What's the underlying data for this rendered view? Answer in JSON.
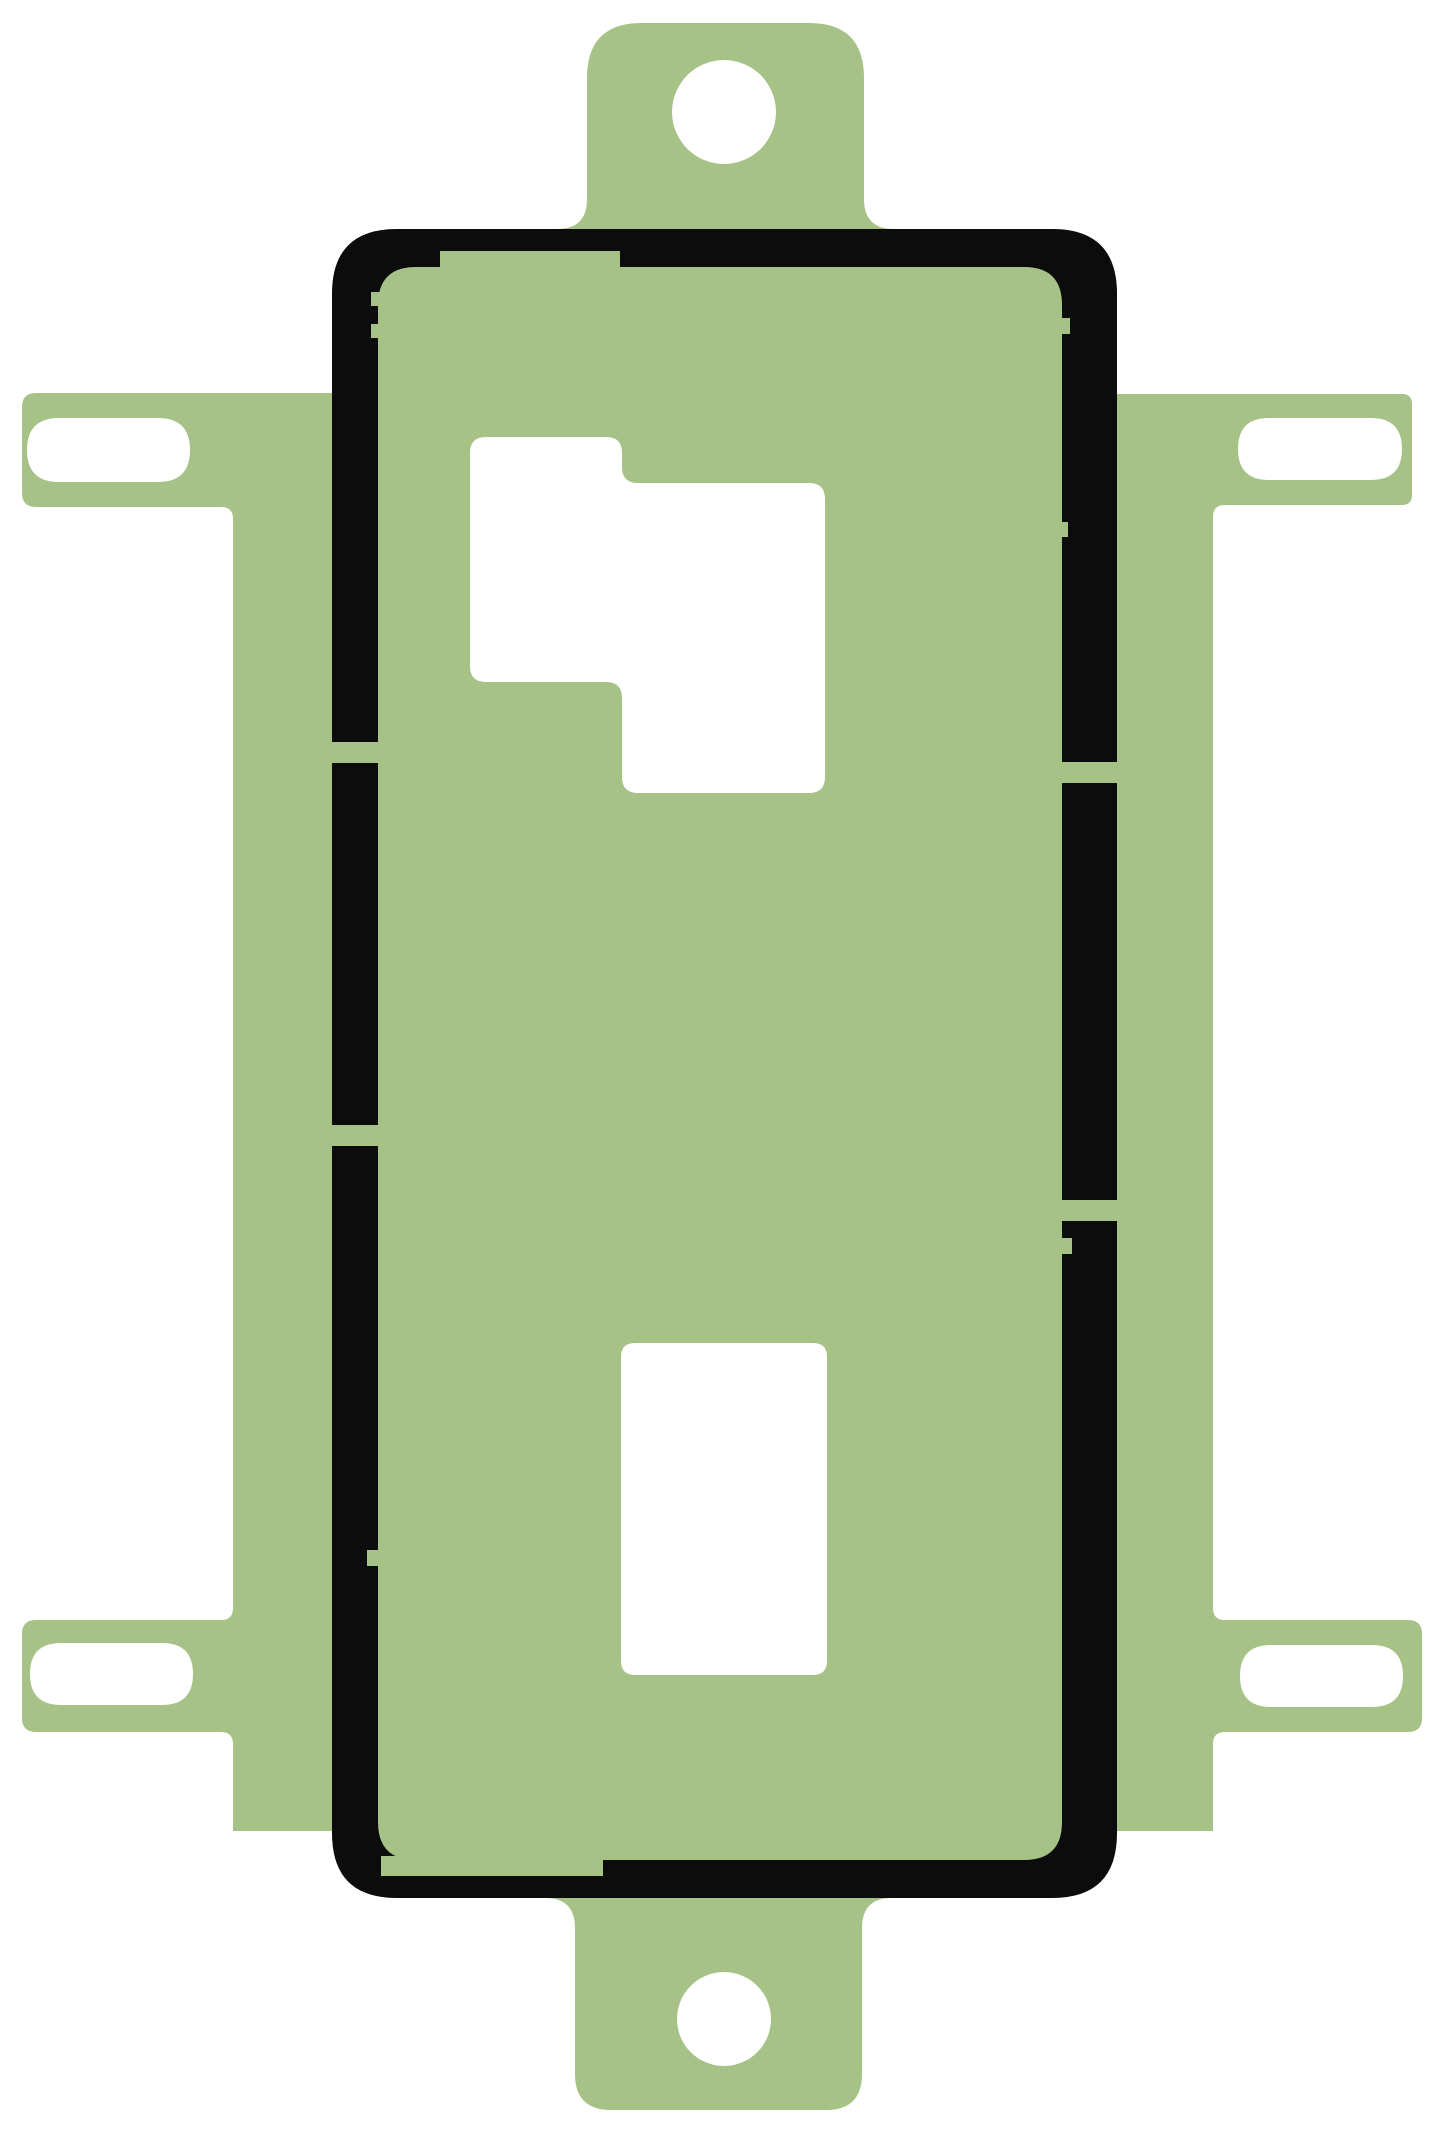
{
  "meta": {
    "viewbox": "0 0 1445 2134",
    "canvas_width": 1445,
    "canvas_height": 2134
  },
  "colors": {
    "background": "#ffffff",
    "liner_green": "#a6c287",
    "adhesive_black": "#0c0c0c",
    "cutout_white": "#ffffff"
  },
  "shapes": {
    "sheet_silhouette": "M 587 78 Q 587 23 642 23 L 809 23 Q 864 23 864 78 L 864 199 Q 864 229 894 229 L 1052 229 Q 1117 229 1117 294 L 1117 394 L 1402 394 Q 1412 394 1412 404 L 1412 495 Q 1412 505 1402 505 L 1225 505 Q 1213 505 1213 517 L 1213 1608 Q 1213 1620 1225 1620 L 1408 1620 Q 1422 1620 1422 1634 L 1422 1718 Q 1422 1732 1408 1732 L 1225 1732 Q 1213 1732 1213 1744 L 1213 1831 L 1117 1831 Q 1117 1898 1050 1898 L 892 1898 Q 862 1898 862 1928 L 862 2074 Q 862 2110 826 2110 L 611 2110 Q 575 2110 575 2074 L 575 1928 Q 575 1898 545 1898 L 399 1898 Q 332 1898 332 1831 L 233 1831 L 233 1744 Q 233 1732 221 1732 L 36 1732 Q 22 1732 22 1718 L 22 1634 Q 22 1620 36 1620 L 221 1620 Q 233 1620 233 1608 L 233 519 Q 233 507 221 507 L 36 507 Q 22 507 22 493 L 22 407 Q 22 393 36 393 L 332 393 L 332 294 Q 332 229 397 229 L 557 229 Q 587 229 587 199 Z M 672 112 A 52 52 0 1 0 776 112 A 52 52 0 1 0 672 112 Z M 677 2019 A 47 47 0 1 0 771 2019 A 47 47 0 1 0 677 2019 Z M 59 418 L 158 418 Q 190 418 190 450 Q 190 482 158 482 L 59 482 Q 27 482 27 450 Q 27 418 59 418 Z M 1269 418 L 1371 418 Q 1402 418 1402 449 Q 1402 480 1371 480 L 1269 480 Q 1238 480 1238 449 Q 1238 418 1269 418 Z M 61 1643 L 162 1643 Q 193 1643 193 1674 Q 193 1705 162 1705 L 61 1705 Q 30 1705 30 1674 Q 30 1643 61 1643 Z M 1271 1645 L 1372 1645 Q 1403 1645 1403 1676 Q 1403 1707 1372 1707 L 1271 1707 Q 1240 1707 1240 1676 Q 1240 1645 1271 1645 Z M 486 437 L 606 437 Q 622 437 622 453 L 622 467 Q 622 483 638 483 L 809 483 Q 825 483 825 499 L 825 777 Q 825 793 809 793 L 638 793 Q 622 793 622 777 L 622 698 Q 622 682 606 682 L 486 682 Q 470 682 470 666 L 470 453 Q 470 437 486 437 Z M 635 1343 L 813 1343 Q 827 1343 827 1357 L 827 1661 Q 827 1675 813 1675 L 635 1675 Q 621 1675 621 1661 L 621 1357 Q 621 1343 635 1343 Z",
    "gasket_ring": "M 397 229 L 1052 229 Q 1117 229 1117 294 L 1117 1833 Q 1117 1898 1052 1898 L 397 1898 Q 332 1898 332 1833 L 332 294 Q 332 229 397 229 Z M 416 267 L 1024 267 Q 1062 267 1062 305 L 1062 1822 Q 1062 1860 1024 1860 L 416 1860 Q 378 1860 378 1822 L 378 305 Q 378 267 416 267 Z",
    "gasket_notches": "M 440 251 L 620 251 L 620 270 L 440 270 Z M 381 1856 L 603 1856 L 603 1876 L 381 1876 Z M 325 742 L 385 742 L 385 763 L 325 763 Z M 325 1125 L 385 1125 L 385 1146 L 325 1146 Z M 1055 762 L 1124 762 L 1124 783 L 1055 783 Z M 1055 1200 L 1124 1200 L 1124 1221 L 1055 1221 Z M 371 292 L 386 292 L 386 306 L 371 306 Z M 371 324 L 386 324 L 386 338 L 371 338 Z M 367 1550 L 384 1550 L 384 1566 L 367 1566 Z M 1053 318 L 1070 318 L 1070 334 L 1053 334 Z M 1051 522 L 1068 522 L 1068 537 L 1051 537 Z M 1055 1238 L 1072 1238 L 1072 1254 L 1055 1254 Z"
  }
}
